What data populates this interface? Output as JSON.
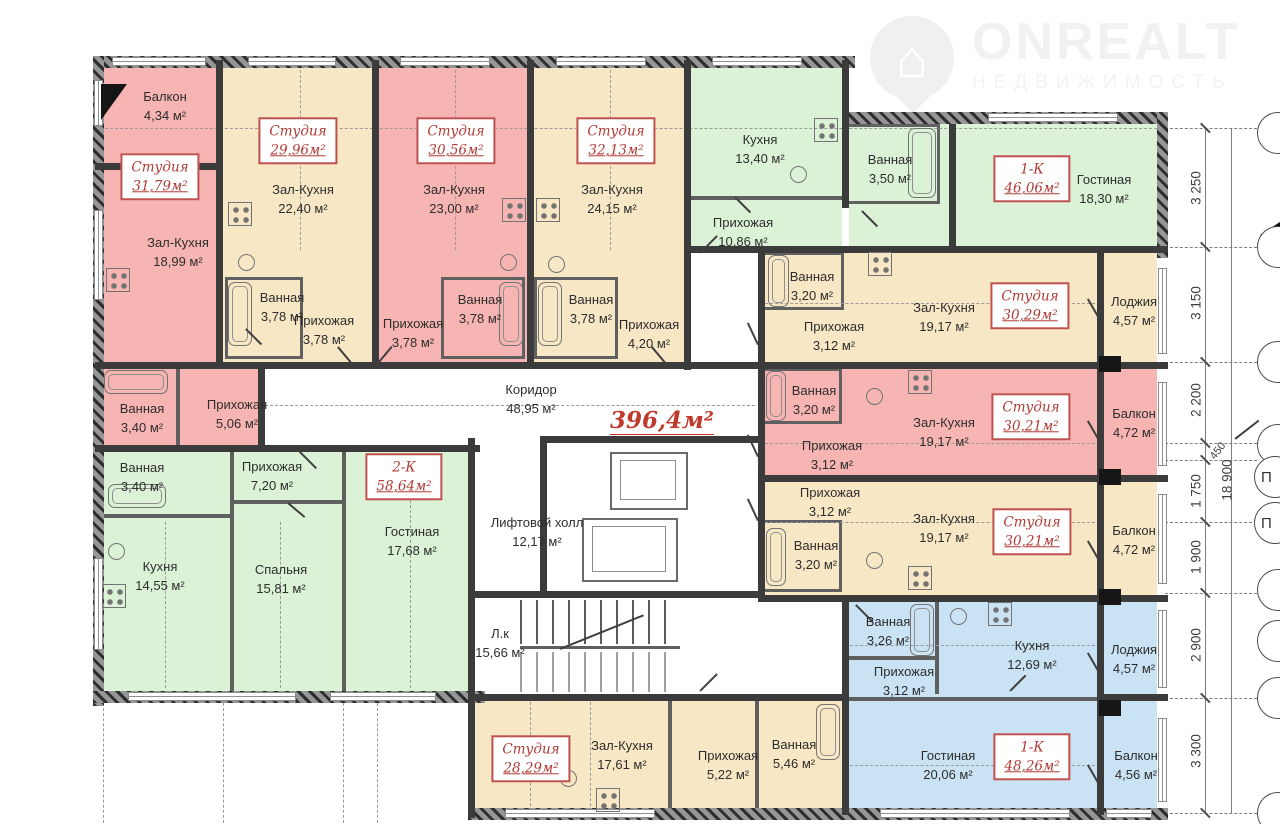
{
  "logo": {
    "brand": "ONREALT",
    "subtitle": "НЕДВИЖИМОСТЬ"
  },
  "plan": {
    "total_area": "396,4м²",
    "corridor": {
      "name": "Коридор",
      "area": "48,95 м²"
    },
    "lift_hall": {
      "name": "Лифтовой холл",
      "area": "12,17 м²"
    },
    "stairwell": {
      "name": "Л.к",
      "area": "15,66 м²"
    }
  },
  "apartments": [
    {
      "type": "Студия",
      "area": "31,79м²",
      "rooms": [
        {
          "name": "Балкон",
          "area": "4,34 м²"
        },
        {
          "name": "Зал-Кухня",
          "area": "18,99 м²"
        },
        {
          "name": "Ванная",
          "area": "3,40 м²"
        },
        {
          "name": "Прихожая",
          "area": "5,06 м²"
        }
      ]
    },
    {
      "type": "Студия",
      "area": "29,96м²",
      "rooms": [
        {
          "name": "Зал-Кухня",
          "area": "22,40 м²"
        },
        {
          "name": "Ванная",
          "area": "3,78 м²"
        },
        {
          "name": "Прихожая",
          "area": "3,78 м²"
        }
      ]
    },
    {
      "type": "Студия",
      "area": "30,56м²",
      "rooms": [
        {
          "name": "Зал-Кухня",
          "area": "23,00 м²"
        },
        {
          "name": "Ванная",
          "area": "3,78 м²"
        },
        {
          "name": "Прихожая",
          "area": "3,78 м²"
        }
      ]
    },
    {
      "type": "Студия",
      "area": "32,13м²",
      "rooms": [
        {
          "name": "Зал-Кухня",
          "area": "24,15 м²"
        },
        {
          "name": "Ванная",
          "area": "3,78 м²"
        },
        {
          "name": "Прихожая",
          "area": "4,20 м²"
        }
      ]
    },
    {
      "type": "1-К",
      "area": "46,06м²",
      "rooms": [
        {
          "name": "Кухня",
          "area": "13,40 м²"
        },
        {
          "name": "Ванная",
          "area": "3,50 м²"
        },
        {
          "name": "Прихожая",
          "area": "10,86 м²"
        },
        {
          "name": "Гостиная",
          "area": "18,30 м²"
        }
      ]
    },
    {
      "type": "Студия",
      "area": "30,29м²",
      "rooms": [
        {
          "name": "Ванная",
          "area": "3,20 м²"
        },
        {
          "name": "Прихожая",
          "area": "3,12 м²"
        },
        {
          "name": "Зал-Кухня",
          "area": "19,17 м²"
        },
        {
          "name": "Лоджия",
          "area": "4,57 м²"
        }
      ]
    },
    {
      "type": "Студия",
      "area": "30,21м²",
      "rooms": [
        {
          "name": "Ванная",
          "area": "3,20 м²"
        },
        {
          "name": "Прихожая",
          "area": "3,12 м²"
        },
        {
          "name": "Зал-Кухня",
          "area": "19,17 м²"
        },
        {
          "name": "Балкон",
          "area": "4,72 м²"
        }
      ]
    },
    {
      "type": "Студия",
      "area": "30,21м²",
      "rooms": [
        {
          "name": "Прихожая",
          "area": "3,12 м²"
        },
        {
          "name": "Ванная",
          "area": "3,20 м²"
        },
        {
          "name": "Зал-Кухня",
          "area": "19,17 м²"
        },
        {
          "name": "Балкон",
          "area": "4,72 м²"
        }
      ]
    },
    {
      "type": "1-К",
      "area": "48,26м²",
      "rooms": [
        {
          "name": "Ванная",
          "area": "3,26 м²"
        },
        {
          "name": "Прихожая",
          "area": "3,12 м²"
        },
        {
          "name": "Кухня",
          "area": "12,69 м²"
        },
        {
          "name": "Лоджия",
          "area": "4,57 м²"
        },
        {
          "name": "Гостиная",
          "area": "20,06 м²"
        },
        {
          "name": "Балкон",
          "area": "4,56 м²"
        }
      ]
    },
    {
      "type": "Студия",
      "area": "28,29м²",
      "rooms": [
        {
          "name": "Зал-Кухня",
          "area": "17,61 м²"
        },
        {
          "name": "Прихожая",
          "area": "5,22 м²"
        },
        {
          "name": "Ванная",
          "area": "5,46 м²"
        }
      ]
    },
    {
      "type": "2-К",
      "area": "58,64м²",
      "rooms": [
        {
          "name": "Ванная",
          "area": "3,40 м²"
        },
        {
          "name": "Прихожая",
          "area": "7,20 м²"
        },
        {
          "name": "Кухня",
          "area": "14,55 м²"
        },
        {
          "name": "Спальня",
          "area": "15,81 м²"
        },
        {
          "name": "Гостиная",
          "area": "17,68 м²"
        }
      ]
    }
  ],
  "dimensions": {
    "right_chain": [
      "3 250",
      "3 150",
      "2 200",
      "1 750",
      "1 900",
      "2 900",
      "3 300"
    ],
    "offset": "450",
    "overall_height": "18 900"
  },
  "grid": {
    "letters": [
      "П",
      "П"
    ]
  },
  "colors": {
    "studio_pink": "#f6b4b2",
    "studio_beige": "#f7e7c5",
    "apartment_green": "#dcf2d7",
    "apartment_blue": "#c9e3f5",
    "label_red": "#b03a36",
    "wall": "#3b3b3b"
  }
}
